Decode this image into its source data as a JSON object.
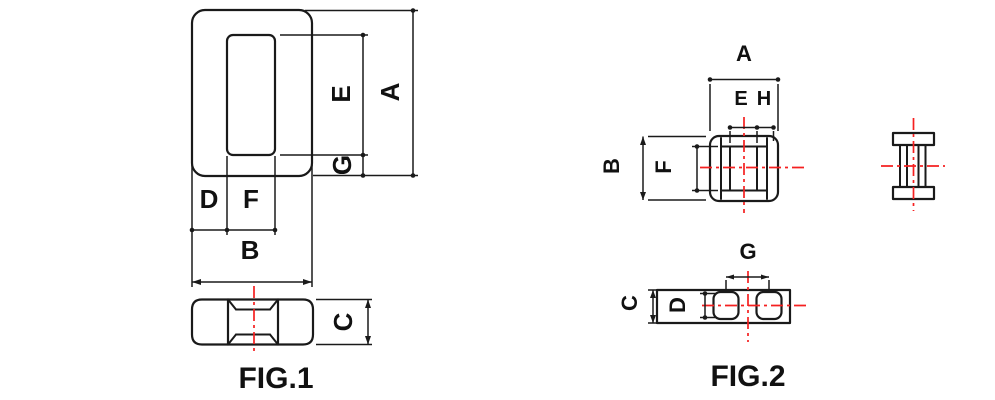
{
  "figures": {
    "fig1": {
      "caption": "FIG.1",
      "labels": {
        "A": "A",
        "E": "E",
        "G": "G",
        "D": "D",
        "F": "F",
        "B": "B",
        "C": "C"
      }
    },
    "fig2": {
      "caption": "FIG.2",
      "labels": {
        "A": "A",
        "E": "E",
        "H": "H",
        "B": "B",
        "F": "F",
        "G": "G",
        "C": "C",
        "D": "D"
      }
    }
  },
  "colors": {
    "outline": "#1a1a1a",
    "centerline_red": "#f52020",
    "hatch_fill": "#c9f2f8",
    "hatch_stroke": "#2ed3e6"
  }
}
